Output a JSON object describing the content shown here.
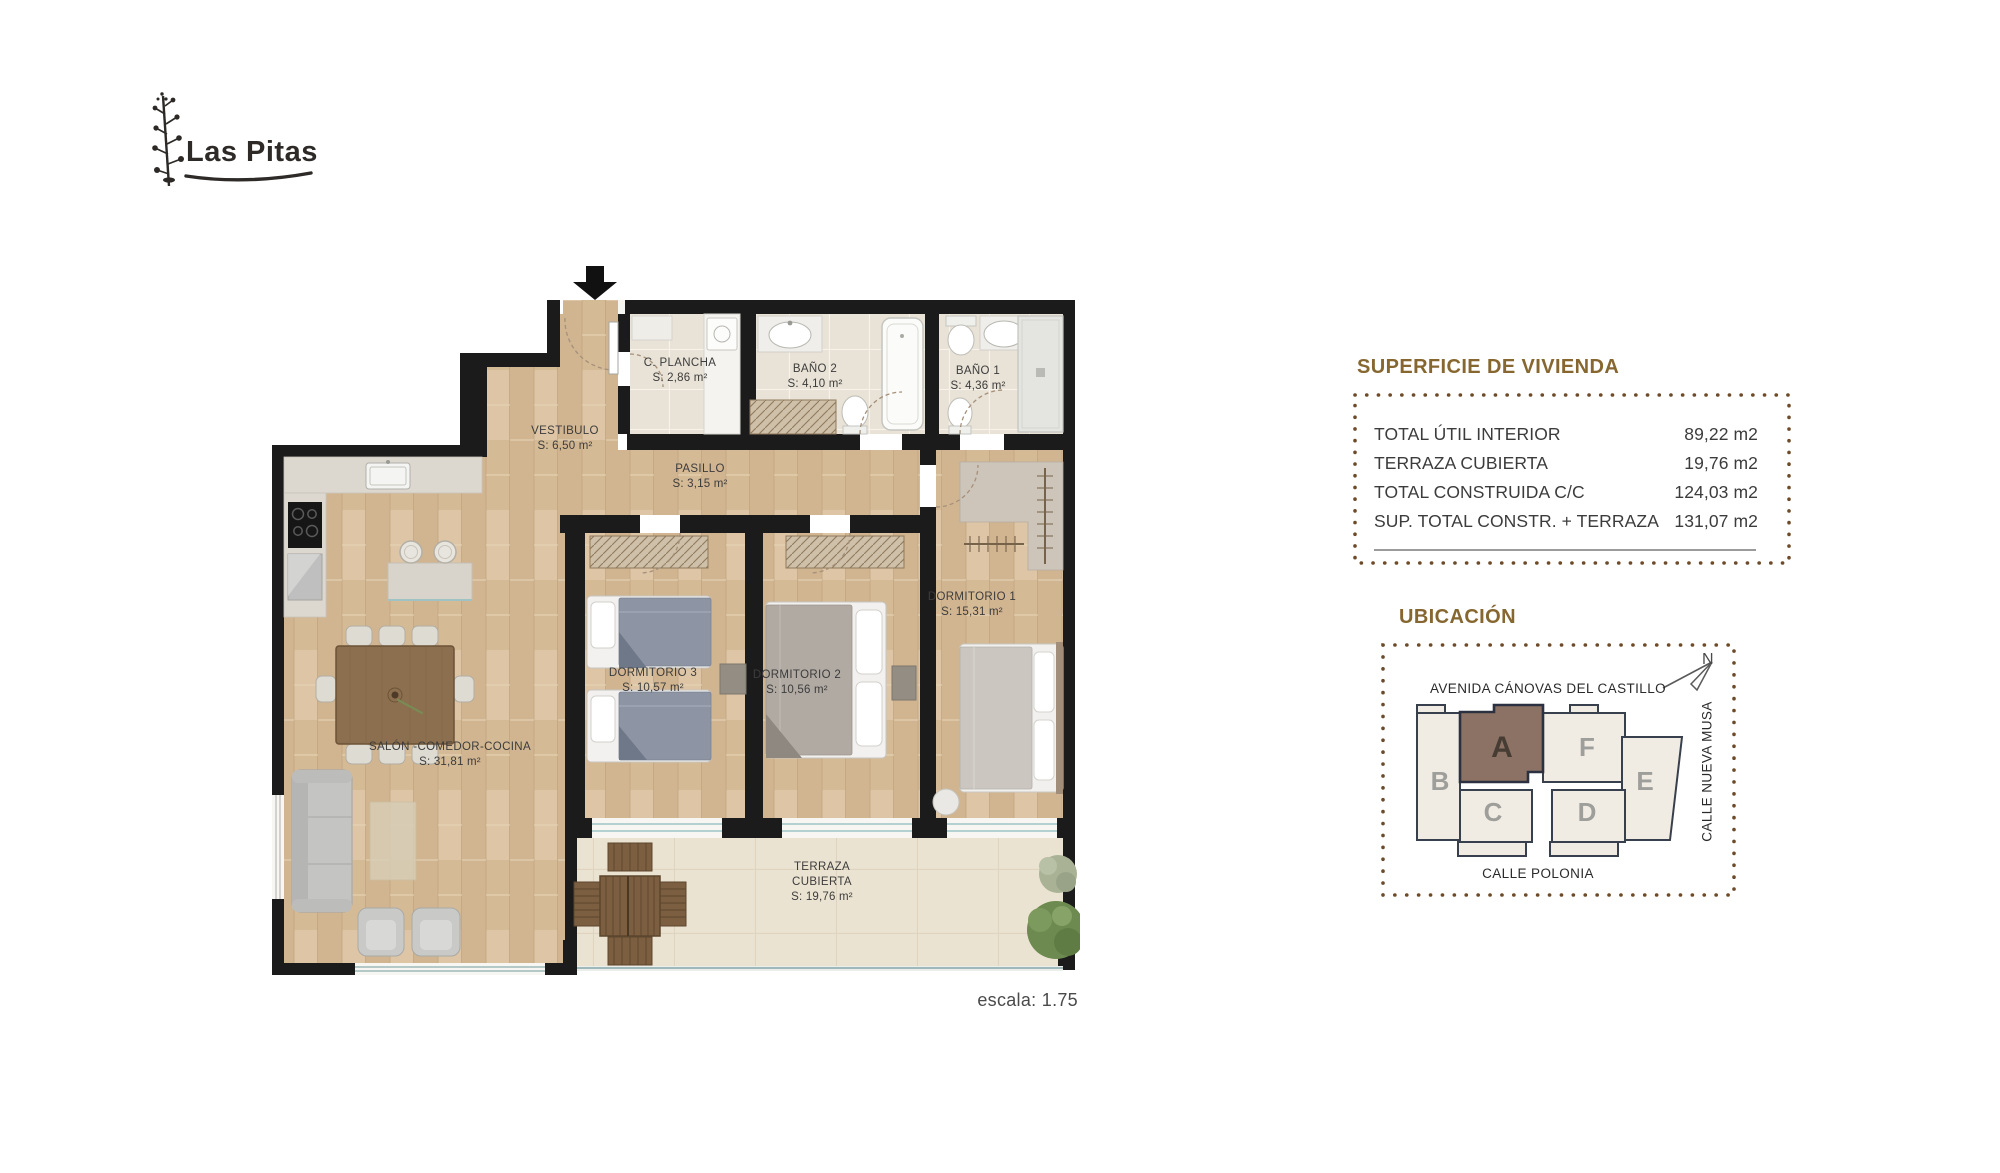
{
  "brand": {
    "name": "Las Pitas"
  },
  "floorplan": {
    "rooms": {
      "c_plancha": {
        "name": "C. PLANCHA",
        "area": "S: 2,86 m²"
      },
      "bano2": {
        "name": "BAÑO 2",
        "area": "S: 4,10 m²"
      },
      "bano1": {
        "name": "BAÑO 1",
        "area": "S: 4,36 m²"
      },
      "vestibulo": {
        "name": "VESTIBULO",
        "area": "S: 6,50 m²"
      },
      "pasillo": {
        "name": "PASILLO",
        "area": "S: 3,15 m²"
      },
      "dormitorio3": {
        "name": "DORMITORIO 3",
        "area": "S: 10,57 m²"
      },
      "dormitorio2": {
        "name": "DORMITORIO 2",
        "area": "S: 10,56 m²"
      },
      "dormitorio1": {
        "name": "DORMITORIO 1",
        "area": "S: 15,31 m²"
      },
      "salon": {
        "name": "SALÓN -COMEDOR-COCINA",
        "area": "S: 31,81 m²"
      },
      "terraza": {
        "line1": "TERRAZA",
        "line2": "CUBIERTA",
        "area": "S: 19,76 m²"
      }
    },
    "scale_note": "escala: 1.75"
  },
  "surface_panel": {
    "title": "SUPERFICIE DE VIVIENDA",
    "rows": [
      {
        "label": "TOTAL ÚTIL INTERIOR",
        "value": "89,22 m2"
      },
      {
        "label": "TERRAZA CUBIERTA",
        "value": "19,76 m2"
      },
      {
        "label": "TOTAL CONSTRUIDA C/C",
        "value": "124,03 m2"
      },
      {
        "label": "SUP. TOTAL CONSTR. + TERRAZA",
        "value": "131,07 m2"
      }
    ]
  },
  "location_panel": {
    "title": "UBICACIÓN",
    "streets": {
      "top": "AVENIDA CÁNOVAS DEL CASTILLO",
      "right": "CALLE NUEVA MUSA",
      "bottom": "CALLE POLONIA"
    },
    "north": "N",
    "units": {
      "a": "A",
      "b": "B",
      "c": "C",
      "d": "D",
      "e": "E",
      "f": "F"
    },
    "highlighted_unit": "A",
    "colors": {
      "accent_brown": "#876730",
      "dot_border": "#6D4A28",
      "unit_highlight": "#8C7264",
      "wall": "#1B1B1B"
    }
  }
}
